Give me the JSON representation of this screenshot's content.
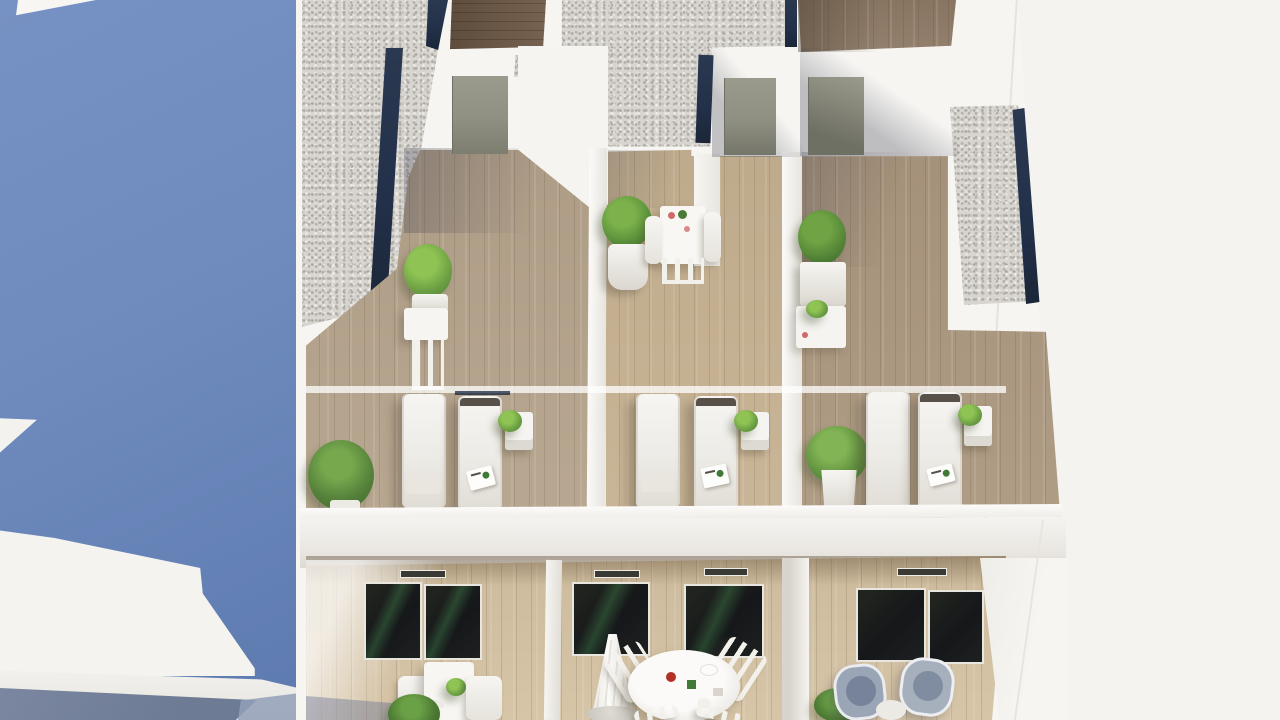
{
  "scene": {
    "type": "architectural-3d-render",
    "title": "Aerial rendering of modern white apartment building with rooftop solarium terraces",
    "view": "top-down isometric aerial",
    "text_visible": "none",
    "areas": {
      "left_facade": "blue shaded side facade with sunlit white geometric wall shapes and slate ground band",
      "roof_level": "gravel roof fields edged with navy trim strips, white parapets, three wooden solarium terraces",
      "solarium_terraces": "each with two white sun loungers, a white side table with small plant, and potted shrubs",
      "upper_amenities": "bistro table with two white chairs and round boxwood in white pot; square planters with side tables",
      "lower_floor": "recessed wood-clad terraces with dark glazed sliding doors, dining set with parasol, square table set, two blue-grey armchairs",
      "right_side": "overexposed white sunlit wall fading into blank background"
    },
    "objects": [
      "gravel-roof-left",
      "gravel-roof-center",
      "gravel-roof-right-parapet",
      "navy-trim-strips",
      "dark-wood-stair-patch",
      "grey-green-doors",
      "terrace-1-loungers",
      "terrace-2-loungers",
      "terrace-3-loungers",
      "side-tables-with-plants",
      "potted-shrubs",
      "bistro-set",
      "square-planter-set",
      "glass-sliding-doors",
      "vent-grilles",
      "closed-parasol",
      "round-dining-table",
      "white-garden-chairs",
      "blue-grey-armchairs",
      "square-patio-table"
    ],
    "counts": {
      "sun_loungers": 6,
      "roof_terraces": 3,
      "lower_terraces": 3,
      "armchairs": 2,
      "parasols": 1
    }
  },
  "palette": {
    "facadeBlue": "#6f8bbd",
    "facadeBlueDark": "#5d7ab0",
    "slate": "#6e7b95",
    "slateLight": "#93a0b8",
    "voidWhite": "#f4f3f0",
    "buildingWhite": "#f6f5f2",
    "shadowWhite": "#e7e5e0",
    "gravel": "#d8d5d0",
    "navy": "#223049",
    "woodT1": "#b5a38b",
    "woodT2": "#c6b191",
    "woodT3": "#ab977e",
    "woodNorth": "#8d7a65",
    "woodDark": "#6f5a47",
    "deck": "#d5c2a3",
    "glassDark": "#191c17",
    "door": "#8f9081",
    "plantBright": "#8fc353",
    "plantMid": "#6da144",
    "plantDark": "#4f7c33",
    "loungerWhite": "#f3f2ef",
    "armchairBlue": "#9aa5b5",
    "armchairCushion": "#76839b",
    "accentRed": "#b23026"
  }
}
